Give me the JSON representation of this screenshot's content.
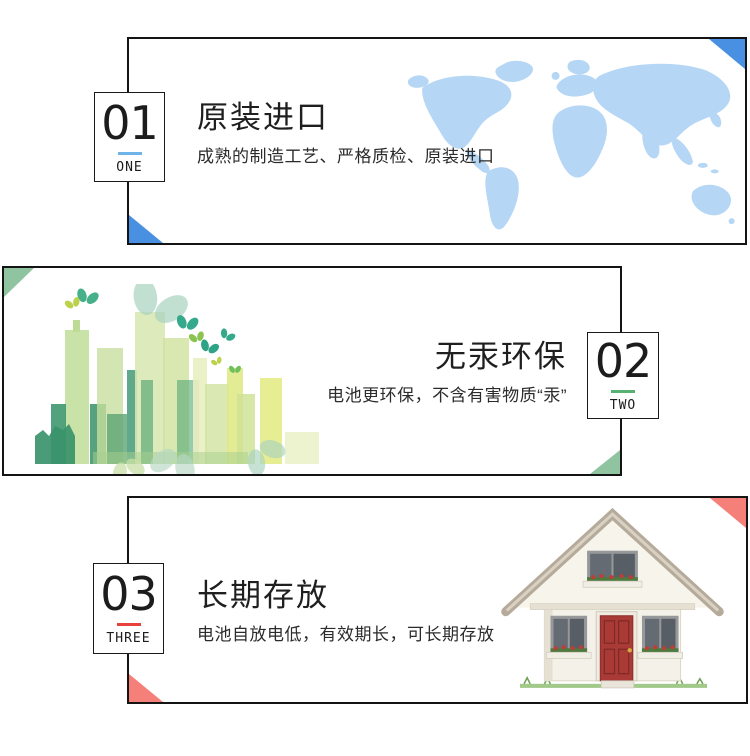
{
  "page": {
    "background": "#ffffff"
  },
  "sections": [
    {
      "number": "01",
      "number_word": "ONE",
      "title": "原装进口",
      "subtitle": "成熟的制造工艺、严格质检、原装进口",
      "accent_color": "#6fb4e8",
      "corner_color": "#4a90e2",
      "illustration": "world-map-icon",
      "illustration_color": "#b5d6f4"
    },
    {
      "number": "02",
      "number_word": "TWO",
      "title": "无汞环保",
      "subtitle": "电池更环保，不含有害物质“汞”",
      "accent_color": "#57b173",
      "corner_color": "#90c4a1",
      "illustration": "green-city-icon",
      "illustration_color": "#9cc86e"
    },
    {
      "number": "03",
      "number_word": "THREE",
      "title": "长期存放",
      "subtitle": "电池自放电低，有效期长，可长期存放",
      "accent_color": "#e8403b",
      "corner_color": "#f5807a",
      "illustration": "house-icon",
      "illustration_color": "#a93a36"
    }
  ]
}
